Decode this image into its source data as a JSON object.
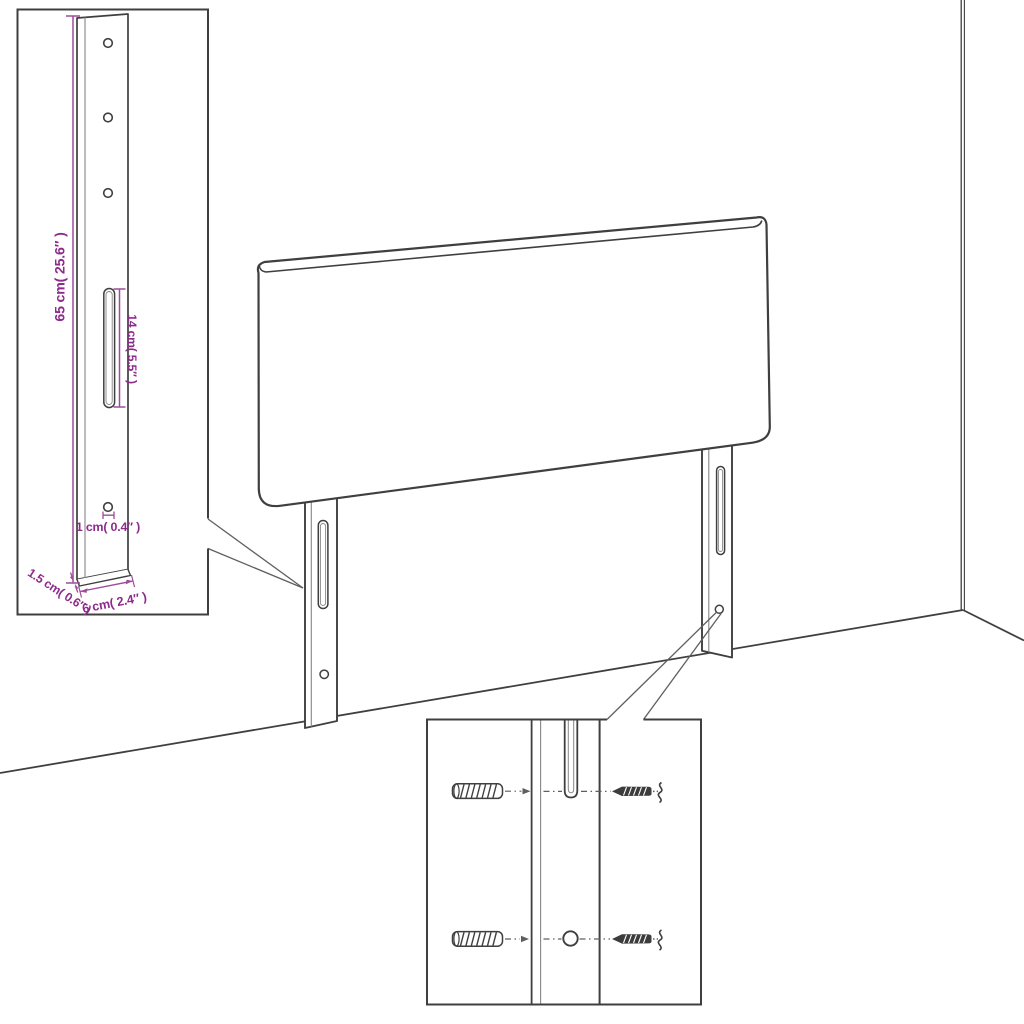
{
  "diagram": {
    "type": "headboard-dimension-diagram",
    "dimensions": {
      "leg_height": "65 cm( 25.6″ )",
      "slot_length": "14 cm( 5.5″ )",
      "hole_diameter": "1 cm( 0.4″ )",
      "leg_thickness": "1.5 cm( 0.6″ )",
      "leg_width": "6 cm( 2.4″ )"
    },
    "icons": {
      "wall_plug": "wall-plug-icon",
      "screw": "screw-icon"
    }
  },
  "colors": {
    "background": "#ffffff",
    "outline": "#3f3f3f",
    "thin_line": "#868686",
    "callout_line": "#5f5f5f",
    "dimension_text": "#8d2b8b",
    "dimension_line": "#9d4d9b"
  }
}
